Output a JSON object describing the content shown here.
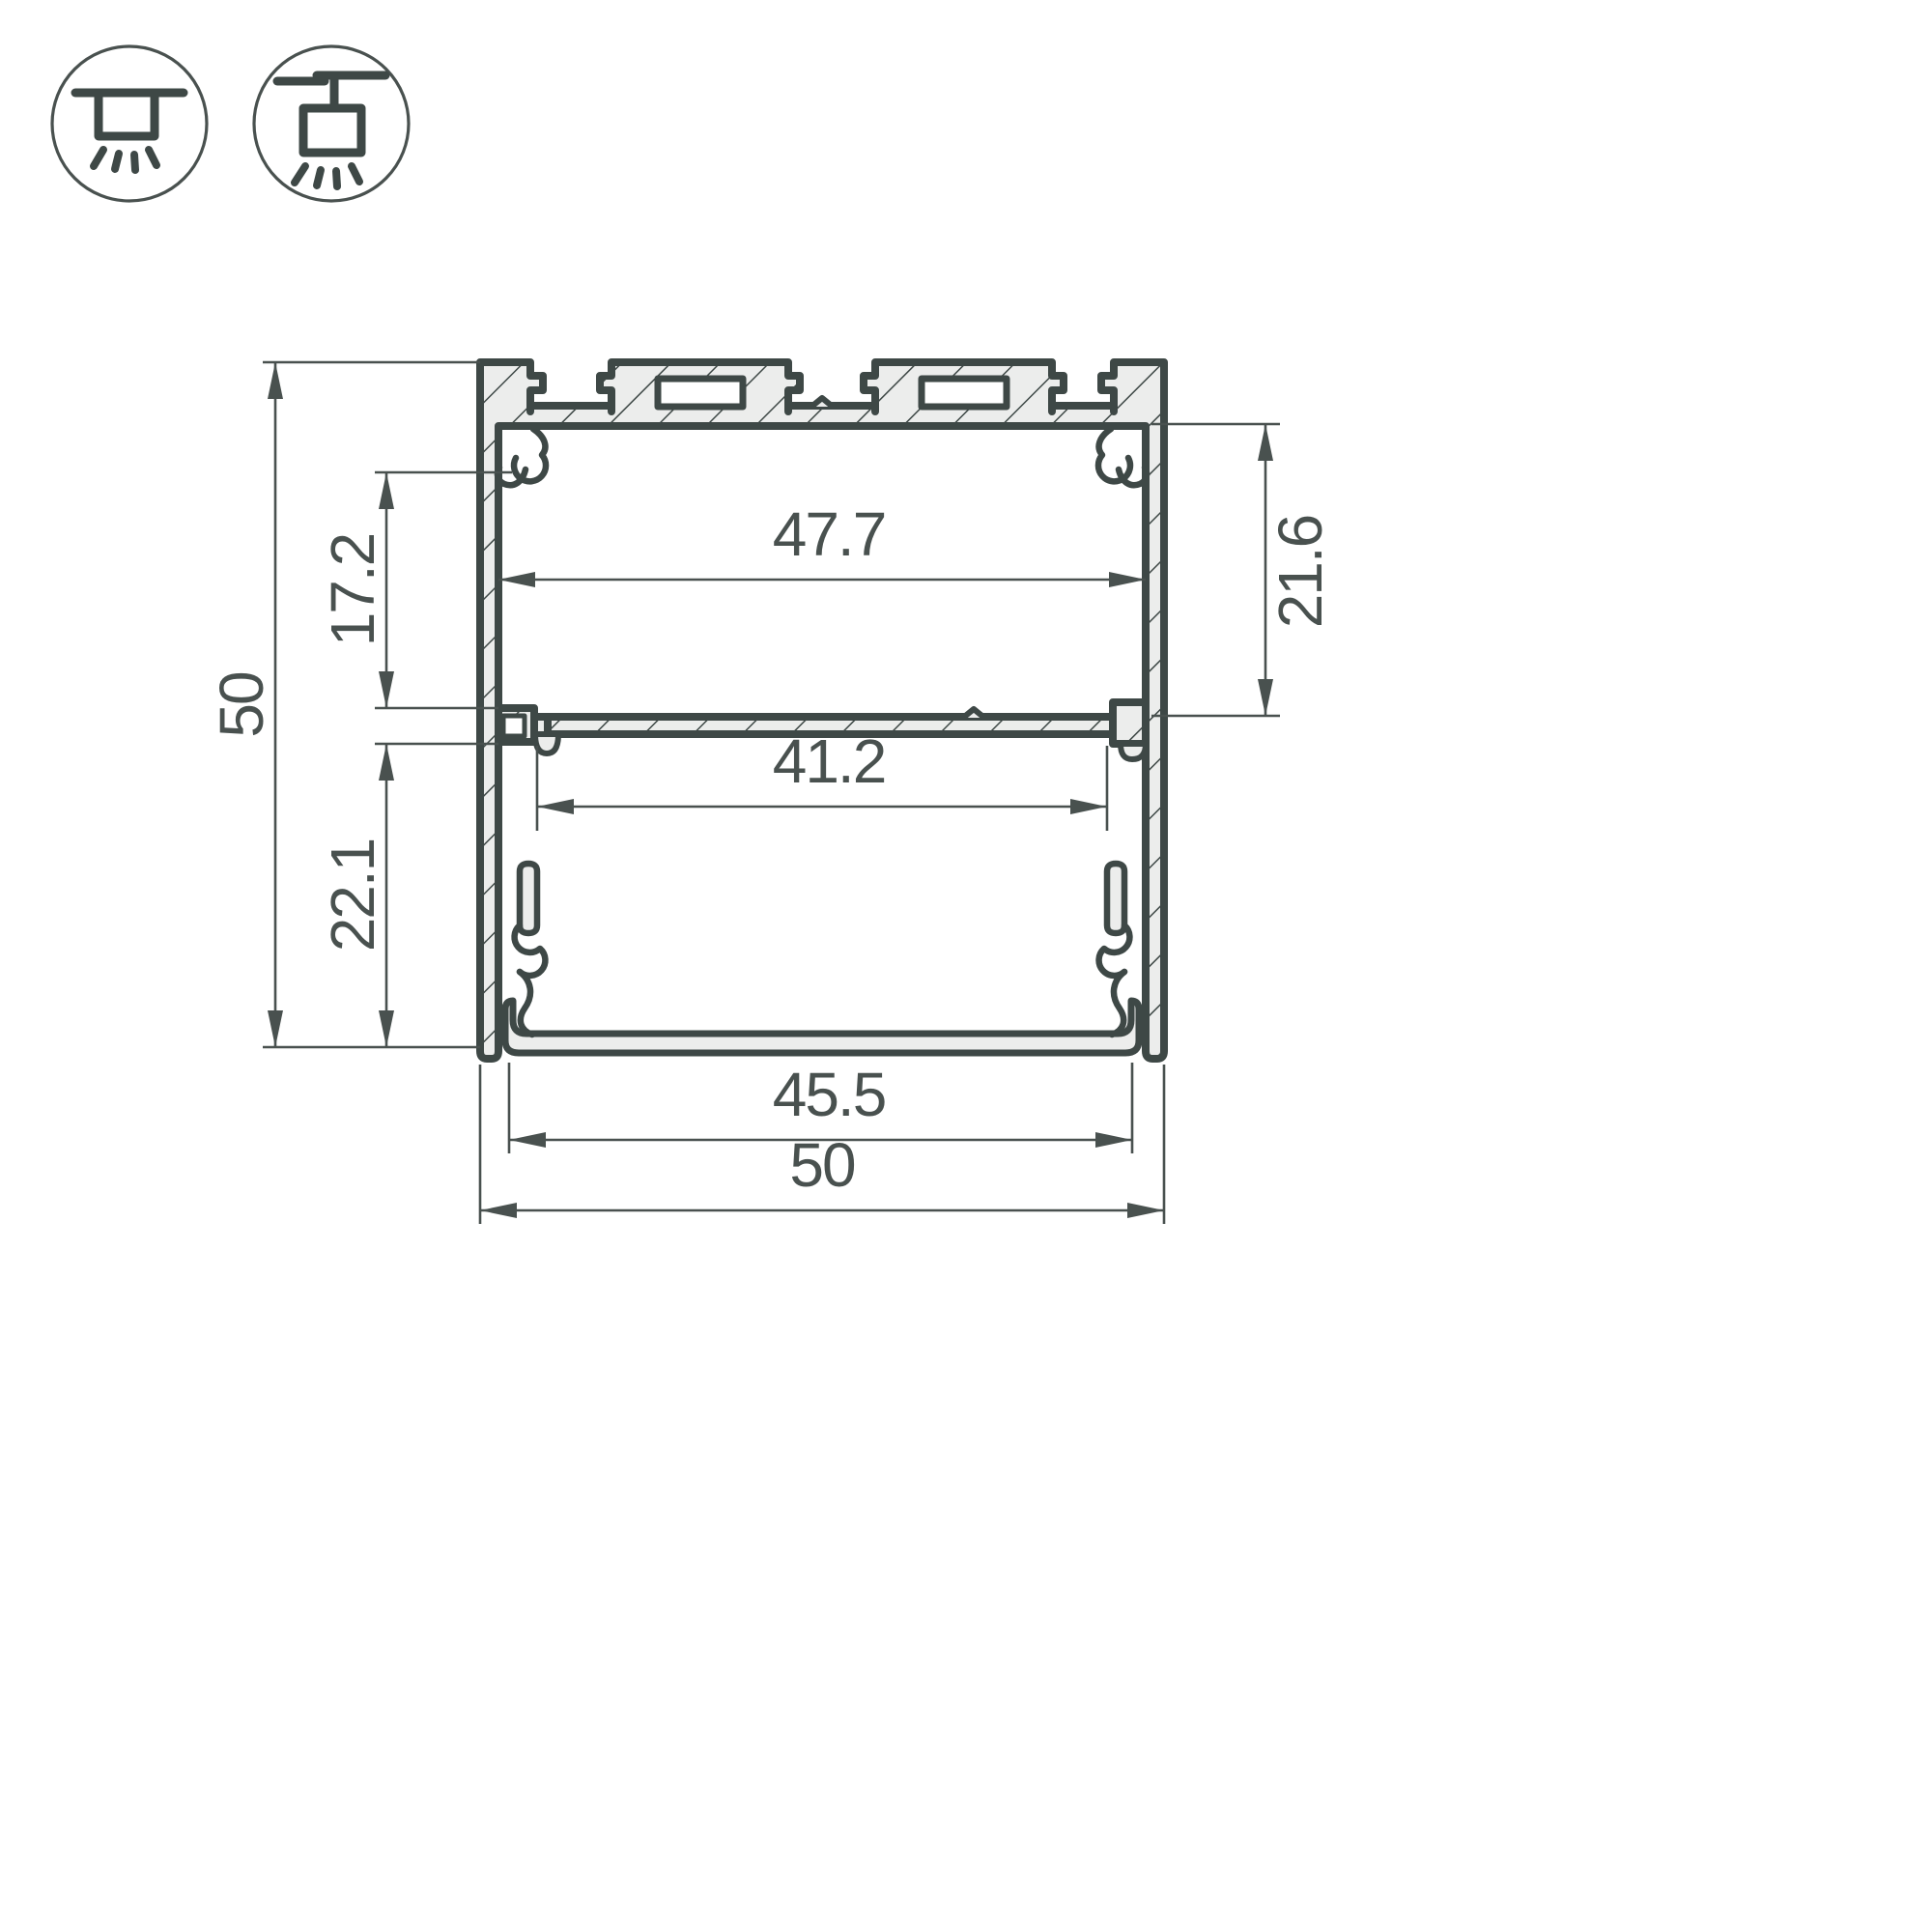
{
  "drawing": {
    "type": "aluminium-led-profile-cross-section",
    "dimensions": {
      "overall_height": "50",
      "overall_width": "50",
      "upper_inner_height": "17.2",
      "lower_inner_height": "22.1",
      "inner_width_top": "47.7",
      "inner_width_lower": "41.2",
      "right_cavity_height": "21.6",
      "bottom_opening_width": "45.5"
    },
    "colors": {
      "outline": "#3e4846",
      "metal_fill": "#ecedec",
      "dimension_lines": "#49514f",
      "text": "#49514f",
      "background": "#ffffff"
    }
  },
  "icons": {
    "surface_mount": {
      "name": "surface-mount-icon"
    },
    "pendant_mount": {
      "name": "pendant-mount-icon"
    }
  }
}
